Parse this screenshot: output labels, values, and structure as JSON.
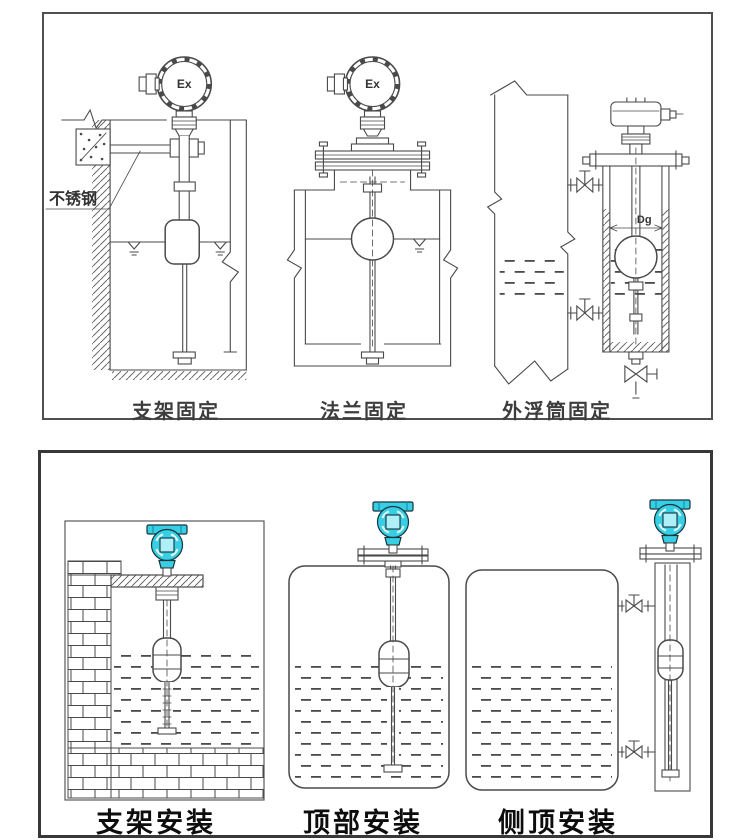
{
  "window": {
    "width": 750,
    "height": 840,
    "background": "#ffffff"
  },
  "colors": {
    "line": "#4a4a4a",
    "top_panel_border": "#4f4f4f",
    "bottom_panel_border": "#383838",
    "transmitter_head_cyan": "#38cfe5",
    "transmitter_display_cyan": "#aeeff8",
    "caption_color": "#0d0d0d"
  },
  "top_panel": {
    "captions": [
      "支架固定",
      "法兰固定",
      "外浮筒固定"
    ],
    "stainless_steel_label": "不锈钢",
    "ex_marking": "Ex",
    "diameter_label": "Dg"
  },
  "bottom_panel": {
    "captions": [
      "支架安装",
      "顶部安装",
      "侧顶安装"
    ]
  }
}
